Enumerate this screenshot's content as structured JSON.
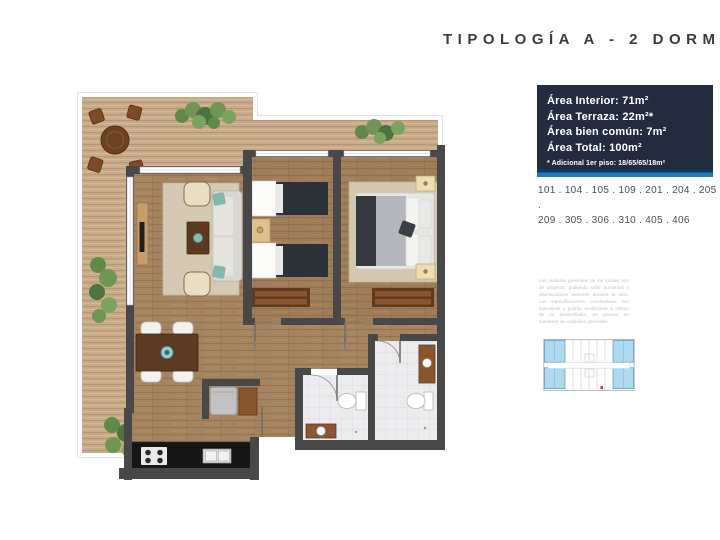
{
  "header": {
    "title": "TIPOLOGÍA A - 2 DORM"
  },
  "info_panel": {
    "lines": [
      "Área Interior: 71m²",
      "Área Terraza: 22m²*",
      "Área bien común: 7m²",
      "Área Total: 100m²"
    ],
    "footnote": "* Adicional 1er piso: 18/65/65/18m²"
  },
  "units": {
    "line1": "101 . 104 . 105 . 109 . 201 . 204 . 205 .",
    "line2": "209 . 305 . 306 . 310 . 405 . 406"
  },
  "disclaimer": "Las medidas generales de los locales son de proyecto, pudiendo sufrir aumentos y disminuciones menores durante la obra. Las especificaciones constructivas son indicativas y podrán modificarse a criterio de su desarrollador, en procura de mantener las calidades generales.",
  "colors": {
    "accent_blue": "#1b7ac2",
    "divider_top": "#10395c",
    "panel_bg": "#232c3e",
    "title_color": "#3c3c3c",
    "terrace_deck": "#c9ab8c",
    "wood_floor": "#a5835f",
    "wall": "#484848",
    "bath_tile": "#ececee",
    "plant_green": "#6f9655",
    "keyplan_unit_highlight": "#aed9ef"
  }
}
